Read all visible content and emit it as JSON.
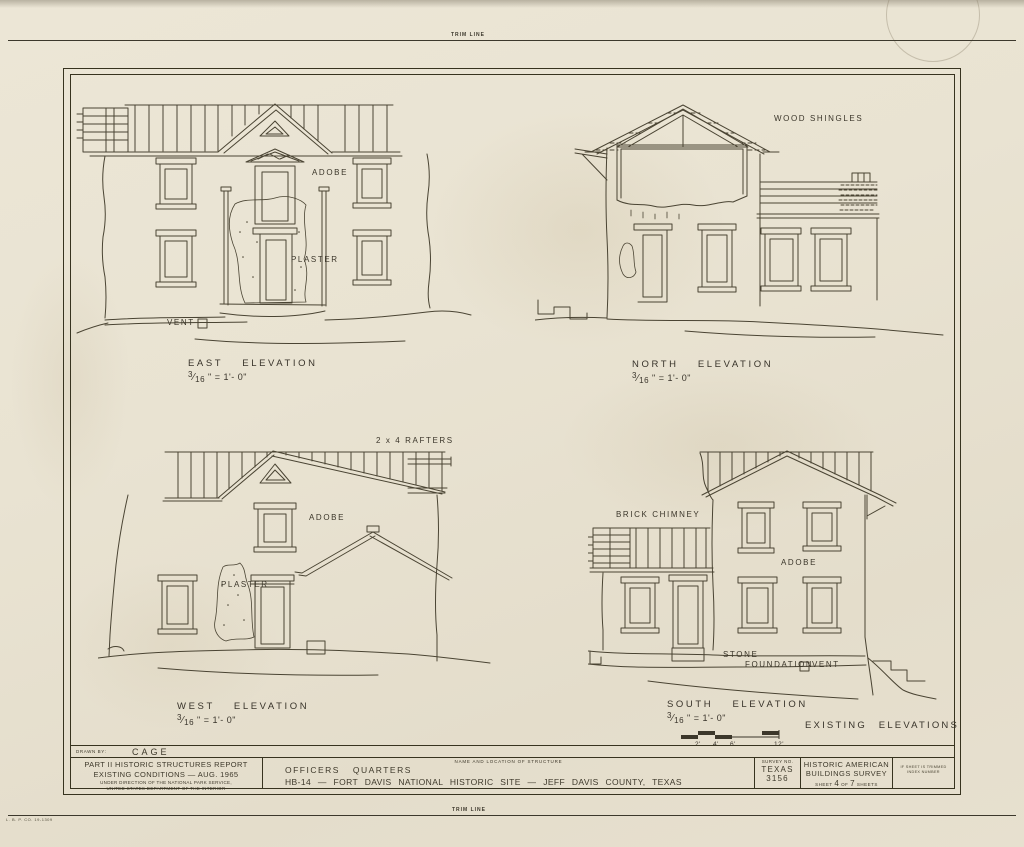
{
  "sheet": {
    "trim_line_top": "TRIM LINE",
    "trim_line_bottom": "TRIM LINE",
    "printer_mark": "L. B. P. CO. 19-1309"
  },
  "glyphs": {
    "frac_slash": "⁄"
  },
  "elevations": {
    "east": {
      "title": "EAST ELEVATION",
      "scale_num": "3",
      "scale_den": "16",
      "scale_rest": "\" = 1'- 0\"",
      "adobe": "ADOBE",
      "plaster": "PLASTER",
      "vent": "VENT"
    },
    "north": {
      "title": "NORTH ELEVATION",
      "scale_num": "3",
      "scale_den": "16",
      "scale_rest": "\" = 1'- 0\"",
      "wood_shingles": "WOOD SHINGLES"
    },
    "west": {
      "title": "WEST ELEVATION",
      "scale_num": "3",
      "scale_den": "16",
      "scale_rest": "\" = 1'- 0\"",
      "rafters": "2 x 4 RAFTERS",
      "adobe": "ADOBE",
      "plaster": "PLASTER"
    },
    "south": {
      "title": "SOUTH ELEVATION",
      "scale_num": "3",
      "scale_den": "16",
      "scale_rest": "\" = 1'- 0\"",
      "brick_chimney": "BRICK CHIMNEY",
      "adobe": "ADOBE",
      "stone": "STONE",
      "foundation": "FOUNDATION",
      "vent": "VENT"
    }
  },
  "notes": {
    "existing_elevations": "EXISTING ELEVATIONS"
  },
  "scale_bar": {
    "ticks": [
      "2'",
      "4'",
      "6'",
      "12'"
    ]
  },
  "title_block": {
    "drawn_by_label": "DRAWN BY:",
    "drawn_by_value": "CAGE",
    "report_line1": "PART II  HISTORIC  STRUCTURES  REPORT",
    "report_line2": "EXISTING  CONDITIONS — AUG. 1965",
    "report_line3": "UNDER DIRECTION OF THE NATIONAL PARK SERVICE,",
    "report_line4": "UNITED STATES DEPARTMENT OF THE INTERIOR",
    "structure_label": "NAME AND LOCATION OF STRUCTURE",
    "structure_name": "OFFICERS QUARTERS",
    "structure_location": "HB-14 — FORT DAVIS NATIONAL HISTORIC SITE — JEFF DAVIS COUNTY, TEXAS",
    "survey_label": "SURVEY NO.",
    "survey_state": "TEXAS",
    "survey_number": "3156",
    "habs_line1": "HISTORIC AMERICAN",
    "habs_line2": "BUILDINGS SURVEY",
    "sheet_word": "SHEET",
    "sheet_number": "4",
    "of_word": "OF",
    "sheet_total": "7",
    "sheets_word": "SHEETS",
    "corner_note_line1": "IF SHEET IS TRIMMED",
    "corner_note_line2": "INDEX NUMBER"
  }
}
